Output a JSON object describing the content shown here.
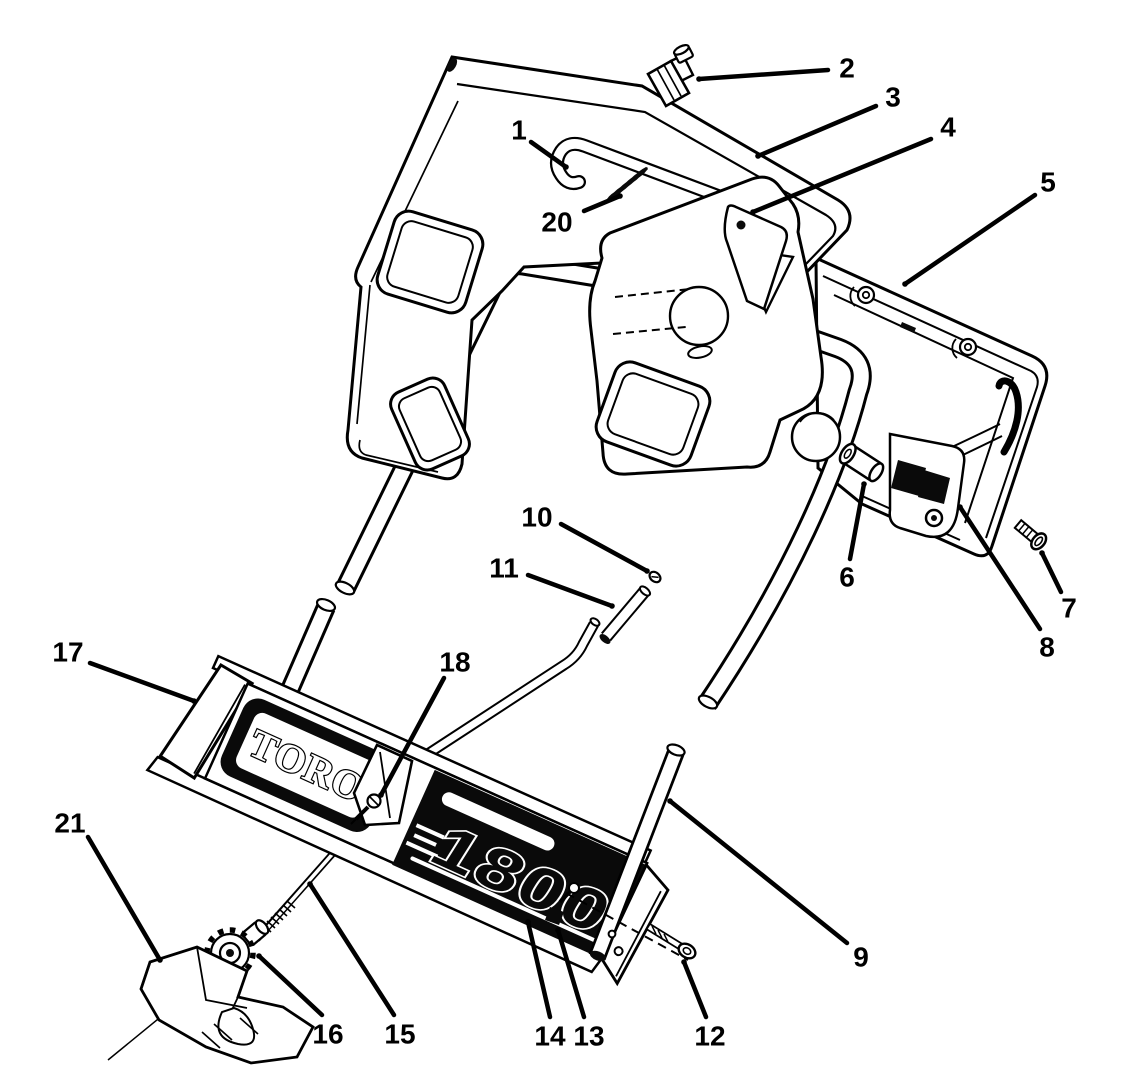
{
  "figure": {
    "kind": "exploded-parts-diagram",
    "subject": "handle assembly line drawing",
    "brand_text": "TORO",
    "model_text": "1800"
  },
  "colors": {
    "background": "#ffffff",
    "line": "#000000",
    "panel_black": "#0a0a0a",
    "label_text": "#000000"
  },
  "callouts": [
    {
      "n": "1",
      "tx": 519,
      "ty": 130,
      "x1": 531,
      "y1": 142,
      "x2": 566,
      "y2": 167
    },
    {
      "n": "2",
      "tx": 847,
      "ty": 68,
      "x1": 828,
      "y1": 70,
      "x2": 699,
      "y2": 79
    },
    {
      "n": "3",
      "tx": 893,
      "ty": 97,
      "x1": 876,
      "y1": 106,
      "x2": 758,
      "y2": 156
    },
    {
      "n": "4",
      "tx": 948,
      "ty": 127,
      "x1": 931,
      "y1": 139,
      "x2": 753,
      "y2": 212
    },
    {
      "n": "5",
      "tx": 1048,
      "ty": 182,
      "x1": 1035,
      "y1": 195,
      "x2": 905,
      "y2": 284
    },
    {
      "n": "6",
      "tx": 847,
      "ty": 577,
      "x1": 850,
      "y1": 559,
      "x2": 864,
      "y2": 484
    },
    {
      "n": "7",
      "tx": 1069,
      "ty": 608,
      "x1": 1061,
      "y1": 592,
      "x2": 1042,
      "y2": 553
    },
    {
      "n": "8",
      "tx": 1047,
      "ty": 647,
      "x1": 1040,
      "y1": 629,
      "x2": 960,
      "y2": 507
    },
    {
      "n": "9",
      "tx": 861,
      "ty": 957,
      "x1": 847,
      "y1": 943,
      "x2": 670,
      "y2": 801
    },
    {
      "n": "10",
      "tx": 537,
      "ty": 517,
      "x1": 561,
      "y1": 524,
      "x2": 647,
      "y2": 571
    },
    {
      "n": "11",
      "tx": 504,
      "ty": 568,
      "x1": 528,
      "y1": 575,
      "x2": 612,
      "y2": 606
    },
    {
      "n": "12",
      "tx": 710,
      "ty": 1036,
      "x1": 706,
      "y1": 1017,
      "x2": 684,
      "y2": 962
    },
    {
      "n": "13",
      "tx": 589,
      "ty": 1036,
      "x1": 584,
      "y1": 1017,
      "x2": 558,
      "y2": 930
    },
    {
      "n": "14",
      "tx": 550,
      "ty": 1036,
      "x1": 550,
      "y1": 1017,
      "x2": 528,
      "y2": 922
    },
    {
      "n": "15",
      "tx": 400,
      "ty": 1034,
      "x1": 394,
      "y1": 1015,
      "x2": 310,
      "y2": 884
    },
    {
      "n": "16",
      "tx": 328,
      "ty": 1034,
      "x1": 322,
      "y1": 1015,
      "x2": 259,
      "y2": 956
    },
    {
      "n": "17",
      "tx": 68,
      "ty": 652,
      "x1": 90,
      "y1": 663,
      "x2": 194,
      "y2": 701
    },
    {
      "n": "18",
      "tx": 455,
      "ty": 662,
      "x1": 444,
      "y1": 678,
      "x2": 381,
      "y2": 795
    },
    {
      "n": "20",
      "tx": 557,
      "ty": 222,
      "x1": 584,
      "y1": 211,
      "x2": 620,
      "y2": 196
    },
    {
      "n": "21",
      "tx": 70,
      "ty": 823,
      "x1": 88,
      "y1": 837,
      "x2": 160,
      "y2": 960
    }
  ]
}
